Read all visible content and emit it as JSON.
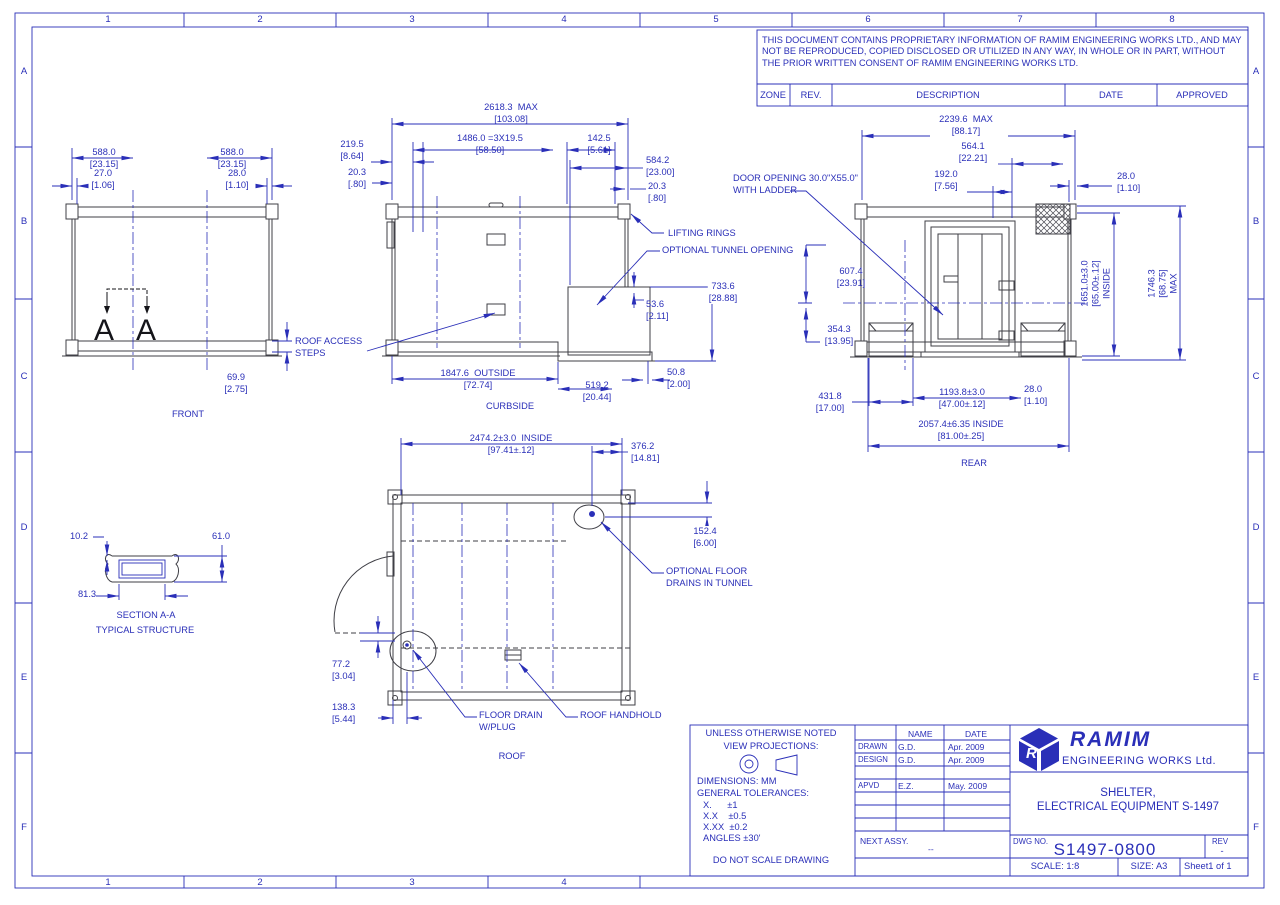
{
  "sheet": {
    "colors": {
      "blue": "#2a2fb8",
      "dark": "#3f3f46"
    },
    "zone_cols": [
      "1",
      "2",
      "3",
      "4",
      "5",
      "6",
      "7",
      "8"
    ],
    "zone_cols_bottom": [
      "1",
      "2",
      "3",
      "4"
    ],
    "zone_rows": [
      "A",
      "B",
      "C",
      "D",
      "E",
      "F"
    ]
  },
  "proprietary": {
    "text": "THIS DOCUMENT CONTAINS PROPRIETARY INFORMATION OF RAMIM ENGINEERING WORKS LTD., AND MAY NOT BE REPRODUCED, COPIED DISCLOSED OR UTILIZED IN ANY WAY, IN WHOLE OR IN PART, WITHOUT THE PRIOR WRITTEN CONSENT OF RAMIM ENGINEERING WORKS LTD."
  },
  "revision_table": {
    "zone": "ZONE",
    "rev": "REV.",
    "description": "DESCRIPTION",
    "date": "DATE",
    "approved": "APPROVED"
  },
  "front": {
    "label": "FRONT",
    "section_letter_left": "A",
    "section_letter_right": "A",
    "dim_588L_mm": "588.0",
    "dim_588L_in": "[23.15]",
    "dim_588R_mm": "588.0",
    "dim_588R_in": "[23.15]",
    "dim_27_mm": "27.0",
    "dim_27_in": "[1.06]",
    "dim_28_mm": "28.0",
    "dim_28_in": "[1.10]",
    "dim_699_mm": "69.9",
    "dim_699_in": "[2.75]"
  },
  "curbside": {
    "label": "CURBSIDE",
    "dim_2618_mm": "2618.3  MAX",
    "dim_2618_in": "[103.08]",
    "dim_2195_mm": "219.5",
    "dim_2195_in": "[8.64]",
    "dim_1486_mm": "1486.0 =3X19.5",
    "dim_1486_in": "[58.50]",
    "dim_1425_mm": "142.5",
    "dim_1425_in": "[5.61]",
    "dim_203L_mm": "20.3",
    "dim_203L_in": "[.80]",
    "dim_5842_mm": "584.2",
    "dim_5842_in": "[23.00]",
    "dim_203R_mm": "20.3",
    "dim_203R_in": "[.80]",
    "dim_536_mm": "53.6",
    "dim_536_in": "[2.11]",
    "dim_7336_mm": "733.6",
    "dim_7336_in": "[28.88]",
    "dim_1847_mm": "1847.6  OUTSIDE",
    "dim_1847_in": "[72.74]",
    "dim_5192_mm": "519.2",
    "dim_5192_in": "[20.44]",
    "dim_508_mm": "50.8",
    "dim_508_in": "[2.00]",
    "callout_lifting": "LIFTING RINGS",
    "callout_tunnel": "OPTIONAL TUNNEL OPENING",
    "callout_steps1": "ROOF ACCESS",
    "callout_steps2": "STEPS"
  },
  "rear": {
    "label": "REAR",
    "dim_2239_mm": "2239.6  MAX",
    "dim_2239_in": "[88.17]",
    "dim_5641_mm": "564.1",
    "dim_5641_in": "[22.21]",
    "dim_192_mm": "192.0",
    "dim_192_in": "[7.56]",
    "dim_28T_mm": "28.0",
    "dim_28T_in": "[1.10]",
    "dim_6074_mm": "607.4",
    "dim_6074_in": "[23.91]",
    "dim_3543_mm": "354.3",
    "dim_3543_in": "[13.95]",
    "dim_4318_mm": "431.8",
    "dim_4318_in": "[17.00]",
    "dim_1193_mm": "1193.8±3.0",
    "dim_1193_in": "[47.00±.12]",
    "dim_28B_mm": "28.0",
    "dim_28B_in": "[1.10]",
    "dim_2057_mm": "2057.4±6.35 INSIDE",
    "dim_2057_in": "[81.00±.25]",
    "dim_1651_mm": "1651.0±3.0",
    "dim_1651_in": "[65.00±.12]",
    "dim_1651_suffix": "INSIDE",
    "dim_1746_mm": "1746.3",
    "dim_1746_in": "[68.75]",
    "dim_1746_suffix": "MAX",
    "callout_door1": "DOOR OPENING 30.0\"X55.0\"",
    "callout_door2": "WITH LADDER"
  },
  "roof": {
    "label": "ROOF",
    "dim_2474_mm": "2474.2±3.0  INSIDE",
    "dim_2474_in": "[97.41±.12]",
    "dim_3762_mm": "376.2",
    "dim_3762_in": "[14.81]",
    "dim_1524_mm": "152.4",
    "dim_1524_in": "[6.00]",
    "dim_772_mm": "77.2",
    "dim_772_in": "[3.04]",
    "dim_1383_mm": "138.3",
    "dim_1383_in": "[5.44]",
    "callout_drains1": "OPTIONAL FLOOR",
    "callout_drains2": "DRAINS IN TUNNEL",
    "callout_floordrain1": "FLOOR DRAIN",
    "callout_floordrain2": "W/PLUG",
    "callout_handhold": "ROOF HANDHOLD"
  },
  "section": {
    "label": "SECTION A-A",
    "sublabel": "TYPICAL STRUCTURE",
    "dim_102": "10.2",
    "dim_610": "61.0",
    "dim_813": "81.3"
  },
  "notes": {
    "heading": "UNLESS OTHERWISE NOTED",
    "projections_label": "VIEW PROJECTIONS:",
    "dims_label": "DIMENSIONS: MM",
    "tol_title": "GENERAL TOLERANCES:",
    "tol_x": "X.      ±1",
    "tol_xx": "X.X    ±0.5",
    "tol_xxx": "X.XX  ±0.2",
    "tol_angles": "ANGLES ±30'",
    "footer": "DO NOT SCALE DRAWING"
  },
  "title_block": {
    "name_header": "NAME",
    "date_header": "DATE",
    "drawn_label": "DRAWN",
    "drawn_name": "G.D.",
    "drawn_date": "Apr. 2009",
    "design_label": "DESIGN",
    "design_name": "G.D.",
    "design_date": "Apr. 2009",
    "apvd_label": "APVD",
    "apvd_name": "E.Z.",
    "apvd_date": "May. 2009",
    "next_assy_label": "NEXT ASSY.",
    "next_assy_value": "--",
    "logo_letter": "R",
    "company_name": "RAMIM",
    "company_sub": "ENGINEERING WORKS Ltd.",
    "title_line1": "SHELTER,",
    "title_line2": "ELECTRICAL EQUIPMENT S-1497",
    "dwg_no_label": "DWG NO.",
    "dwg_no": "S1497-0800",
    "rev_label": "REV",
    "rev_value": "-",
    "scale": "SCALE: 1:8",
    "size": "SIZE: A3",
    "sheet": "Sheet1 of 1"
  }
}
